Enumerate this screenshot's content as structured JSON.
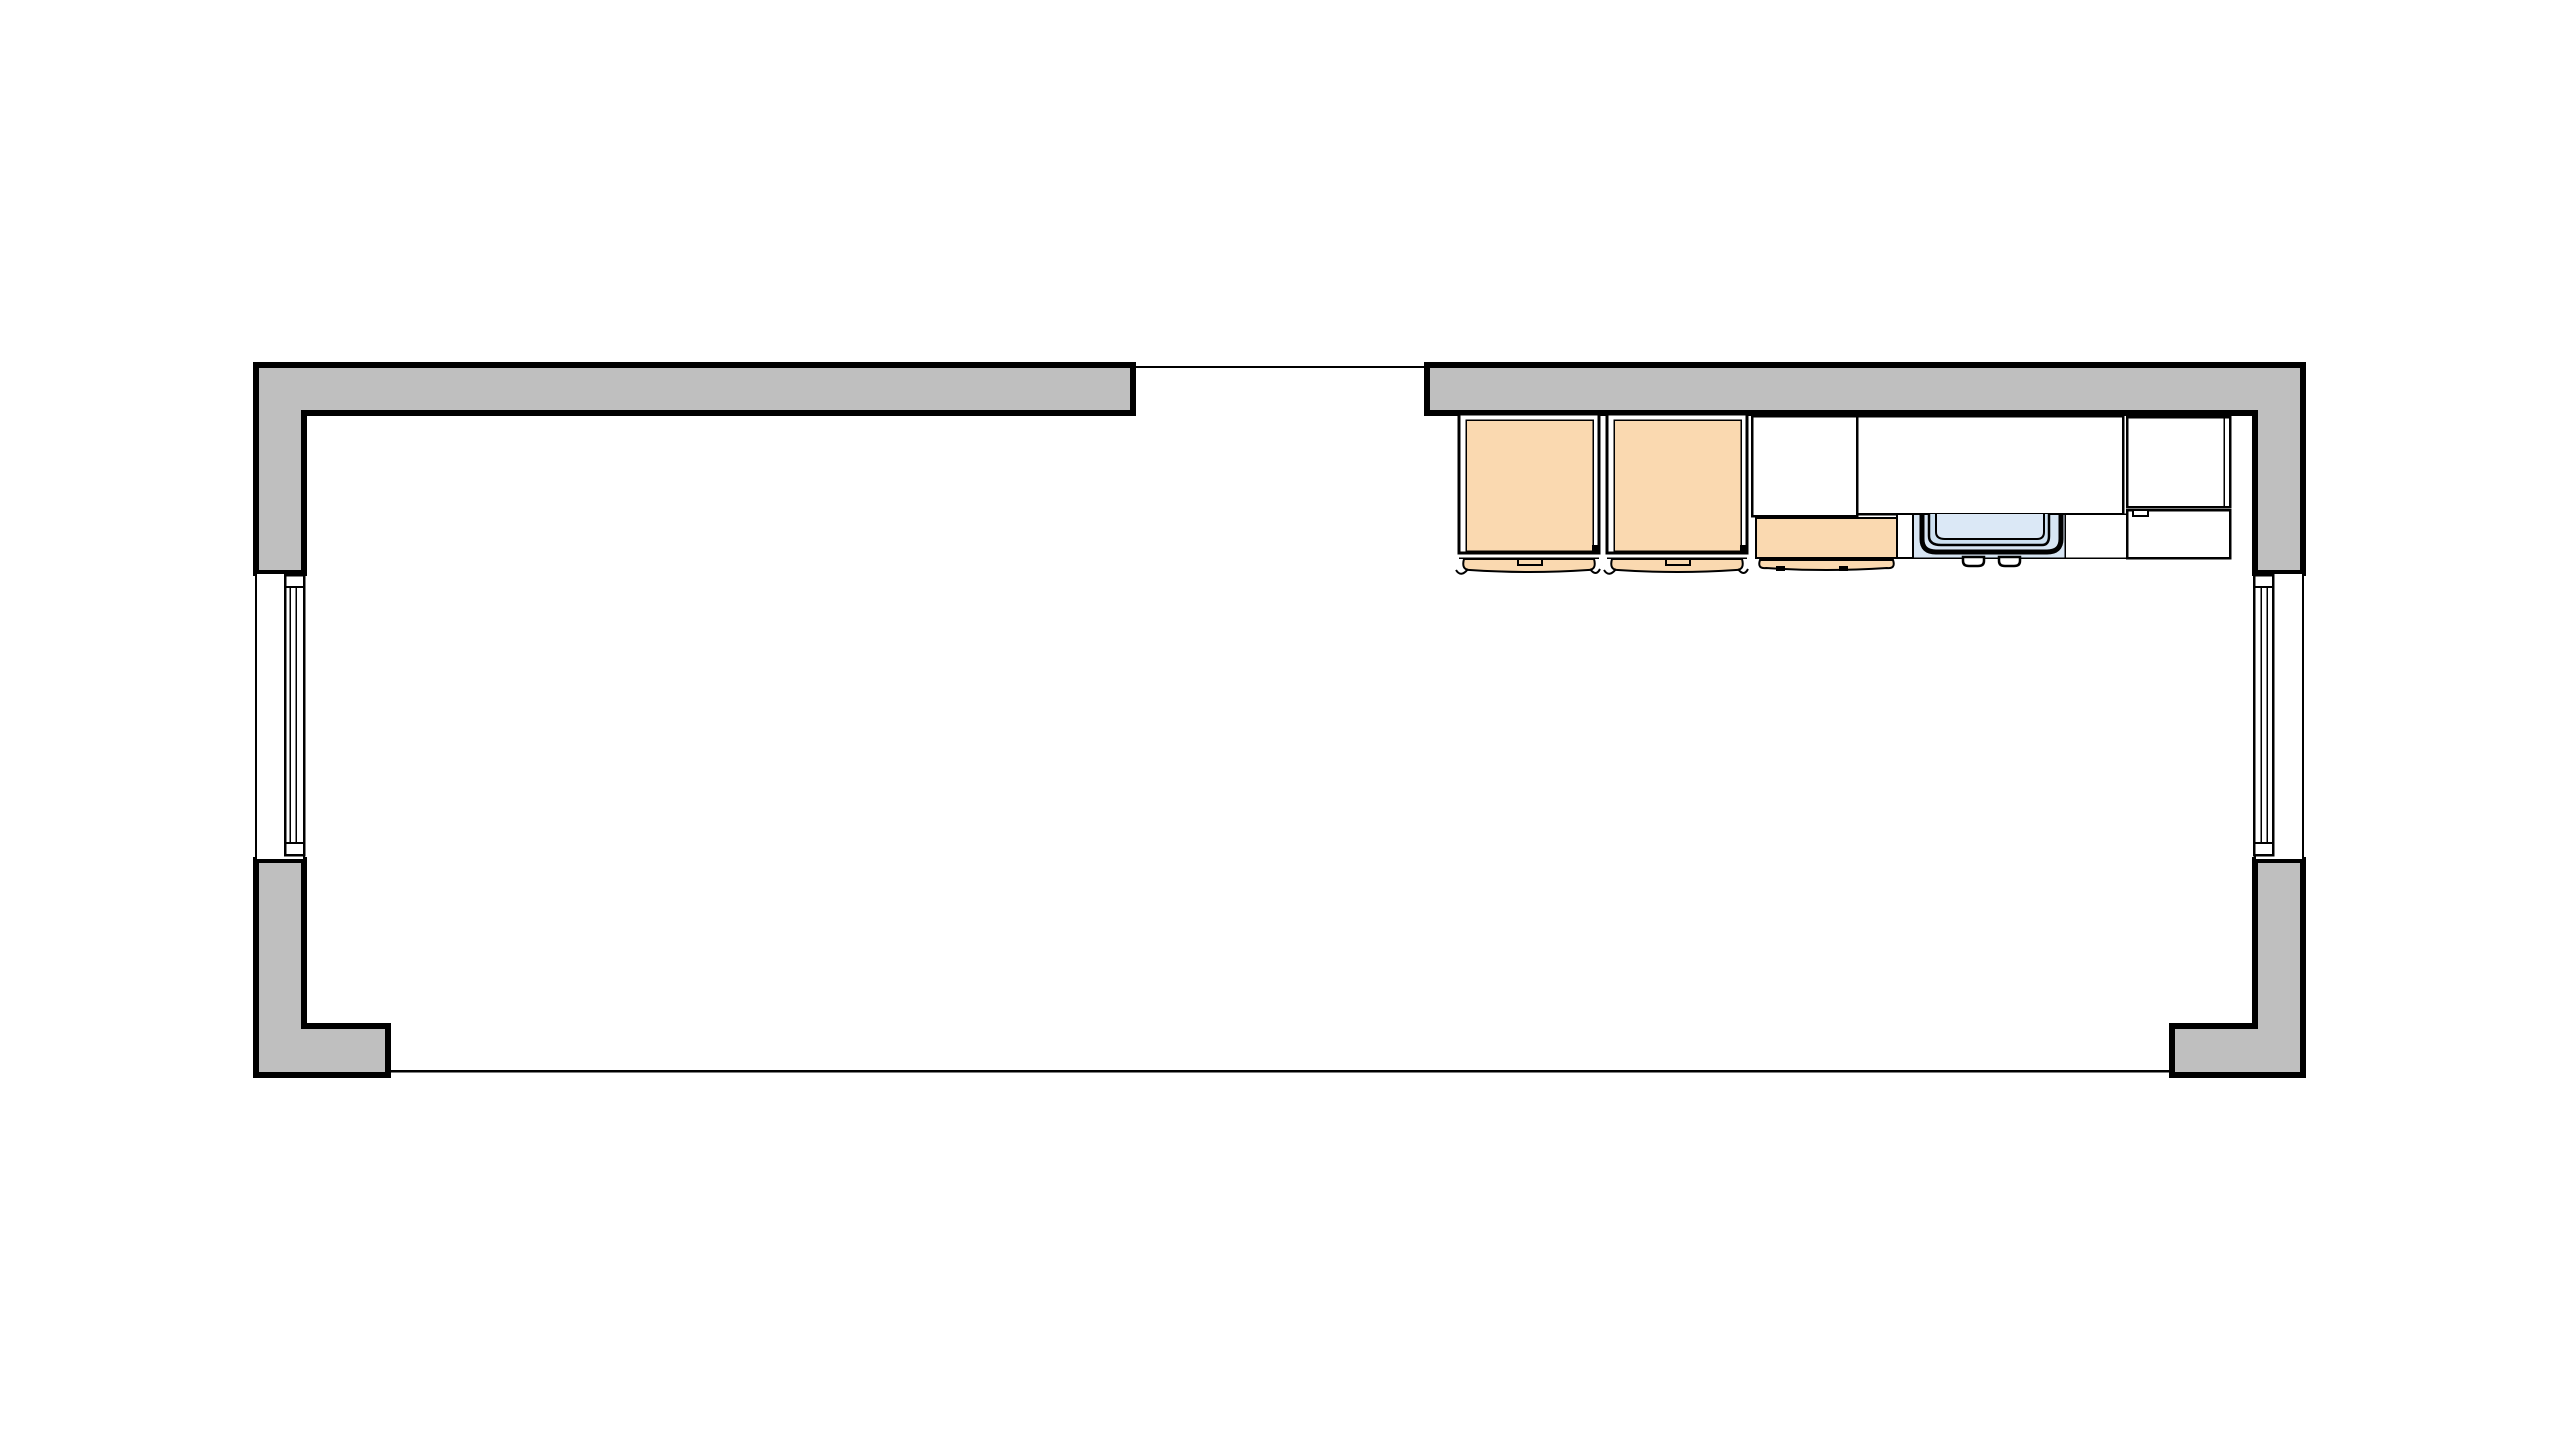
{
  "colors": {
    "white": "#ffffff",
    "outline": "#000000",
    "wall": "#bfbfbf",
    "cabinet": "#fad9b0",
    "sink_area": "#d7e5f3",
    "sink_mid": "#cde0f0",
    "sink_inner": "#dbe8f6"
  },
  "scene": {
    "type": "top-down architectural floor plan",
    "walls": [
      "wall-top-left",
      "wall-top-right",
      "wall-corner-bottom-left",
      "wall-corner-bottom-right"
    ],
    "windows": [
      "window-left",
      "window-right"
    ],
    "openings": [
      "top-center-opening",
      "bottom-opening"
    ],
    "kitchen_items": [
      "base-cabinet-1",
      "base-cabinet-2",
      "wall-cabinet-left",
      "wall-cabinet-right",
      "base-cabinet-front",
      "kitchen-sink",
      "side-cabinet-upper",
      "side-cabinet-lower"
    ]
  }
}
